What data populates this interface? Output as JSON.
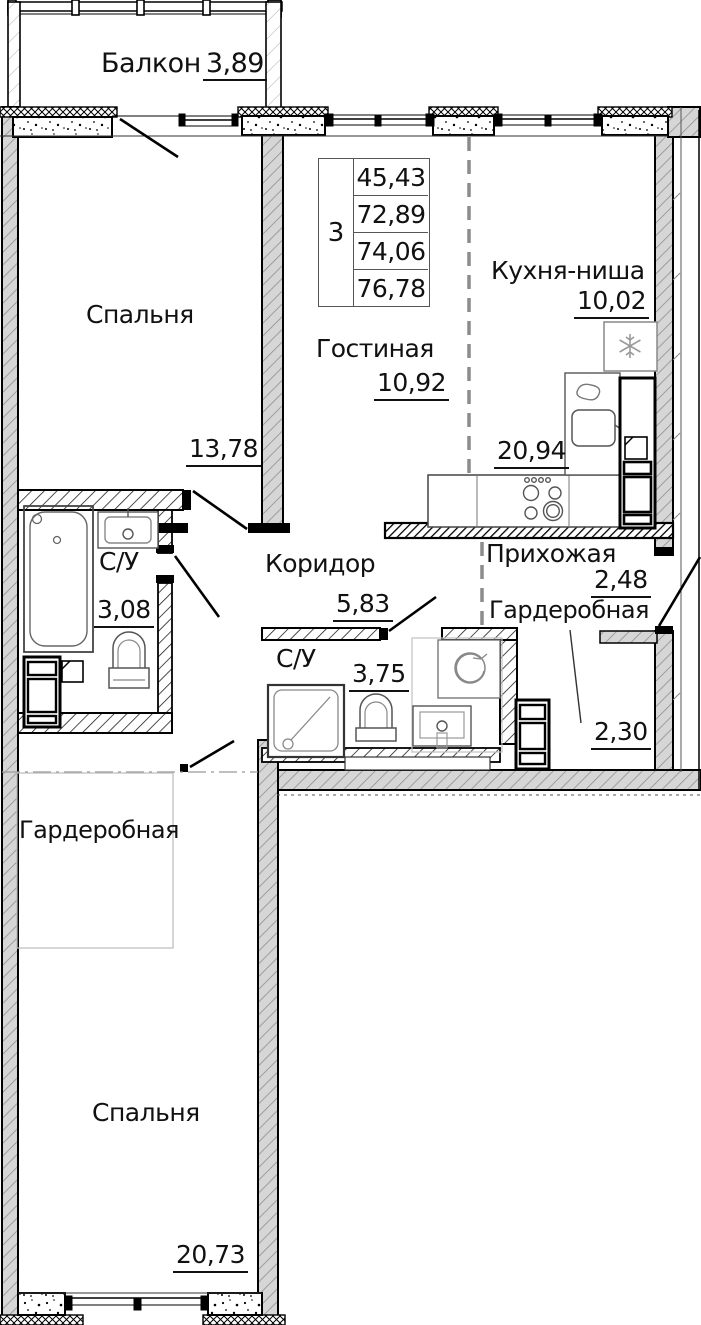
{
  "info_table": {
    "rooms_count": "3",
    "values": [
      "45,43",
      "72,89",
      "74,06",
      "76,78"
    ]
  },
  "rooms": {
    "balcony": {
      "label": "Балкон",
      "area": "3,89"
    },
    "bedroom_top": {
      "label": "Спальня",
      "area": "13,78"
    },
    "living_room": {
      "label": "Гостиная",
      "area": "10,92"
    },
    "kitchen": {
      "label": "Кухня-ниша",
      "area": "10,02"
    },
    "kitchen_living_combined": {
      "area": "20,94"
    },
    "bathroom_left": {
      "label": "С/У",
      "area": "3,08"
    },
    "corridor": {
      "label": "Коридор",
      "area": "5,83"
    },
    "hallway": {
      "label": "Прихожая",
      "area": "2,48"
    },
    "wardrobe_hall": {
      "label": "Гардеробная",
      "area": "2,30"
    },
    "bathroom_center": {
      "label": "С/У",
      "area": "3,75"
    },
    "wardrobe_left": {
      "label": "Гардеробная"
    },
    "bedroom_bottom": {
      "label": "Спальня",
      "area": "20,73"
    }
  },
  "colors": {
    "wall_fill": "#d6d6d6",
    "line": "#000000",
    "dashed_partition": "#8c8c8c"
  }
}
